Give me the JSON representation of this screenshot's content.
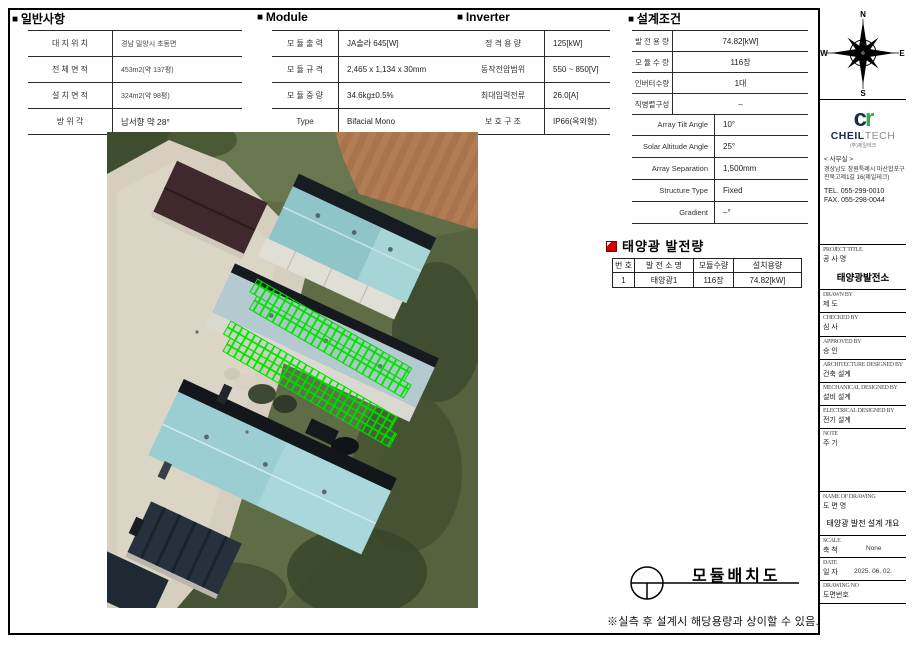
{
  "sheet": {
    "drawing_caption": "모듈배치도",
    "bottom_note": "※실측 후 설계시 해당용량과 상이할 수 있음."
  },
  "general": {
    "title": "일반사항",
    "rows": [
      {
        "label": "대 지 위 치",
        "value": "경남 밀양시 초동면"
      },
      {
        "label": "전 체 면 적",
        "value": "453m2(약 137평)"
      },
      {
        "label": "설 치 면 적",
        "value": "324m2(약 98평)"
      },
      {
        "label": "방  위  각",
        "value": "남서향 약 28°"
      }
    ]
  },
  "module": {
    "title": "Module",
    "rows": [
      {
        "label": "모 듈 출 력",
        "value": "JA솔라 645[W]"
      },
      {
        "label": "모 듈 규 격",
        "value": "2,465 x 1,134 x 30mm"
      },
      {
        "label": "모 듈 중 량",
        "value": "34.6kg±0.5%"
      },
      {
        "label": "Type",
        "value": "Bifacial Mono"
      }
    ]
  },
  "inverter": {
    "title": "Inverter",
    "rows": [
      {
        "label": "정 격 용 량",
        "value": "125[kW]"
      },
      {
        "label": "동작전압범위",
        "value": "550 ~ 850[V]"
      },
      {
        "label": "최대입력전류",
        "value": "26.0[A]"
      },
      {
        "label": "보 호 구 조",
        "value": "IP66(옥외형)"
      }
    ]
  },
  "design": {
    "title": "설계조건",
    "rows": [
      {
        "label": "발 전 용 량",
        "value": "74.82[kW]"
      },
      {
        "label": "모 듈 수 량",
        "value": "116장"
      },
      {
        "label": "인버터수량",
        "value": "1대"
      },
      {
        "label": "직병렬구성",
        "value": "–"
      }
    ],
    "array_rows": [
      {
        "label": "Array Tilt Angle",
        "value": "10°"
      },
      {
        "label": "Solar Altitude Angle",
        "value": "25°"
      },
      {
        "label": "Array Separation",
        "value": "1,500mm"
      },
      {
        "label": "Structure Type",
        "value": "Fixed"
      },
      {
        "label": "Gradient",
        "value": "–°"
      }
    ]
  },
  "generation": {
    "title": "태양광 발전량",
    "headers": [
      "번 호",
      "발 전 소 명",
      "모듈수량",
      "설치용량"
    ],
    "row": [
      "1",
      "태양광1",
      "116장",
      "74.82[kW]"
    ]
  },
  "titleblock": {
    "compass": {
      "north": "N",
      "east": "E",
      "south": "S",
      "west": "W"
    },
    "company": {
      "mark_c": "c",
      "mark_r": "r",
      "name_primary": "CHEIL",
      "name_secondary": "TECH",
      "name_sub": "(주)제일테크"
    },
    "office": {
      "heading": "< 사무실 >",
      "address1": "경상남도 창원특례시 마산합포구",
      "address2": "진북고제1길 16(제일테크)",
      "tel": "TEL. 055-299-0010",
      "fax": "FAX. 055-298-0044"
    },
    "fields": [
      {
        "en": "PROJECT TITLE",
        "ko": "공 사 명",
        "value": "태양광발전소"
      },
      {
        "en": "DRAWN BY",
        "ko": "제 도",
        "value": ""
      },
      {
        "en": "CHECKED BY",
        "ko": "심 사",
        "value": ""
      },
      {
        "en": "APPROVED BY",
        "ko": "승 인",
        "value": ""
      },
      {
        "en": "ARCHITECTURE DESIGNED BY",
        "ko": "건축 설계",
        "value": ""
      },
      {
        "en": "MECHANICAL DESIGNED BY",
        "ko": "설비 설계",
        "value": ""
      },
      {
        "en": "ELECTRICAL DESIGNED BY",
        "ko": "전기 설계",
        "value": ""
      },
      {
        "en": "NOTE",
        "ko": "주 기",
        "value": ""
      },
      {
        "en": "NAME OF DRAWING",
        "ko": "도 면 명",
        "value": "태양광 발전 설계 개요"
      },
      {
        "en": "SCALE",
        "ko": "축 척",
        "value": "None"
      },
      {
        "en": "DATE",
        "ko": "일 자",
        "value": "2025. 06. 02."
      },
      {
        "en": "DRAWING NO",
        "ko": "도면번호",
        "value": ""
      }
    ]
  },
  "colors": {
    "accent_red": "#d40000",
    "logo_navy": "#1c2b4e",
    "logo_green": "#2fae4a",
    "panel_overlay_green": "#00dd00",
    "line_black": "#000000"
  }
}
